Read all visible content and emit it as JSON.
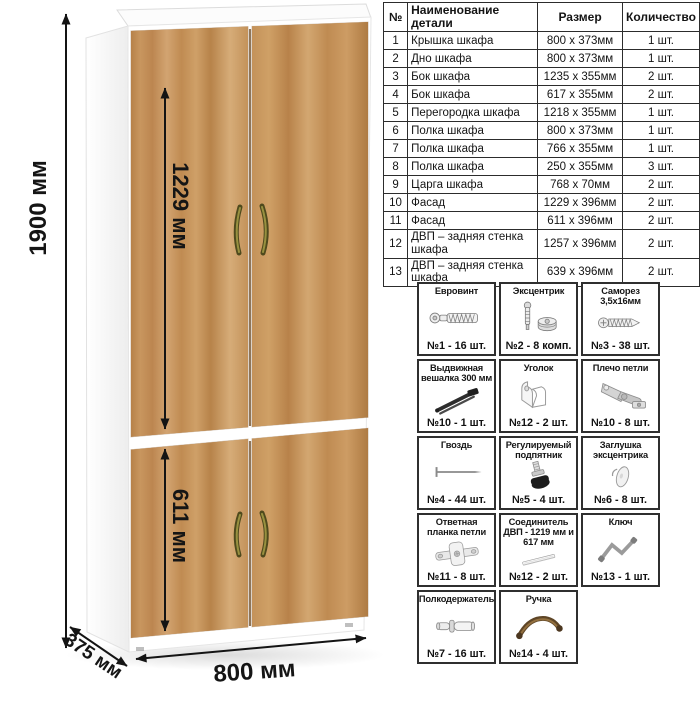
{
  "figure": {
    "height_label": "1900 мм",
    "upper_doors_label": "1229 мм",
    "lower_doors_label": "611 мм",
    "width_label": "800 мм",
    "depth_label": "375 мм",
    "wood_color": "#c29058",
    "handle_color": "#6b652a"
  },
  "parts_table": {
    "headers": [
      "№",
      "Наименование детали",
      "Размер",
      "Количество"
    ],
    "rows": [
      {
        "num": "1",
        "name": "Крышка шкафа",
        "size": "800 х 373мм",
        "qty": "1 шт."
      },
      {
        "num": "2",
        "name": "Дно шкафа",
        "size": "800 х 373мм",
        "qty": "1 шт."
      },
      {
        "num": "3",
        "name": "Бок шкафа",
        "size": "1235 х 355мм",
        "qty": "2 шт."
      },
      {
        "num": "4",
        "name": "Бок шкафа",
        "size": "617 х 355мм",
        "qty": "2 шт."
      },
      {
        "num": "5",
        "name": "Перегородка шкафа",
        "size": "1218 х 355мм",
        "qty": "1 шт."
      },
      {
        "num": "6",
        "name": "Полка шкафа",
        "size": "800 х 373мм",
        "qty": "1 шт."
      },
      {
        "num": "7",
        "name": "Полка шкафа",
        "size": "766 х 355мм",
        "qty": "1 шт."
      },
      {
        "num": "8",
        "name": "Полка шкафа",
        "size": "250 х 355мм",
        "qty": "3 шт."
      },
      {
        "num": "9",
        "name": "Царга шкафа",
        "size": "768 х 70мм",
        "qty": "2 шт."
      },
      {
        "num": "10",
        "name": "Фасад",
        "size": "1229 х 396мм",
        "qty": "2 шт."
      },
      {
        "num": "11",
        "name": "Фасад",
        "size": "611 х 396мм",
        "qty": "2 шт."
      },
      {
        "num": "12",
        "name": "ДВП – задняя стенка шкафа",
        "size": "1257 х 396мм",
        "qty": "2 шт."
      },
      {
        "num": "13",
        "name": "ДВП – задняя стенка шкафа",
        "size": "639 х 396мм",
        "qty": "2 шт."
      }
    ]
  },
  "hardware_items": [
    {
      "title": "Евровинт",
      "count": "№1 - 16 шт.",
      "icon": "euro-screw"
    },
    {
      "title": "Эксцентрик",
      "count": "№2 - 8 комп.",
      "icon": "cam-lock"
    },
    {
      "title": "Саморез 3,5х16мм",
      "count": "№3 - 38 шт.",
      "icon": "small-screw"
    },
    {
      "title": "Выдвижная вешалка 300 мм",
      "count": "№10 - 1 шт.",
      "icon": "pull-out-hanger"
    },
    {
      "title": "Уголок",
      "count": "№12 - 2 шт.",
      "icon": "corner-bracket"
    },
    {
      "title": "Плечо петли",
      "count": "№10 - 8 шт.",
      "icon": "hinge-arm"
    },
    {
      "title": "Гвоздь",
      "count": "№4 - 44 шт.",
      "icon": "nail"
    },
    {
      "title": "Регулируемый подпятник",
      "count": "№5 - 4 шт.",
      "icon": "adjustable-foot"
    },
    {
      "title": "Заглушка эксцентрика",
      "count": "№6 - 8 шт.",
      "icon": "cam-cover"
    },
    {
      "title": "Ответная планка петли",
      "count": "№11 - 8 шт.",
      "icon": "hinge-plate"
    },
    {
      "title": "Соединитель ДВП - 1219 мм и 617 мм",
      "count": "№12 - 2 шт.",
      "icon": "hdf-connector"
    },
    {
      "title": "Ключ",
      "count": "№13 - 1 шт.",
      "icon": "hex-key"
    },
    {
      "title": "Полкодержатель",
      "count": "№7 - 16 шт.",
      "icon": "shelf-pin"
    },
    {
      "title": "Ручка",
      "count": "№14 - 4 шт.",
      "icon": "door-handle"
    }
  ]
}
